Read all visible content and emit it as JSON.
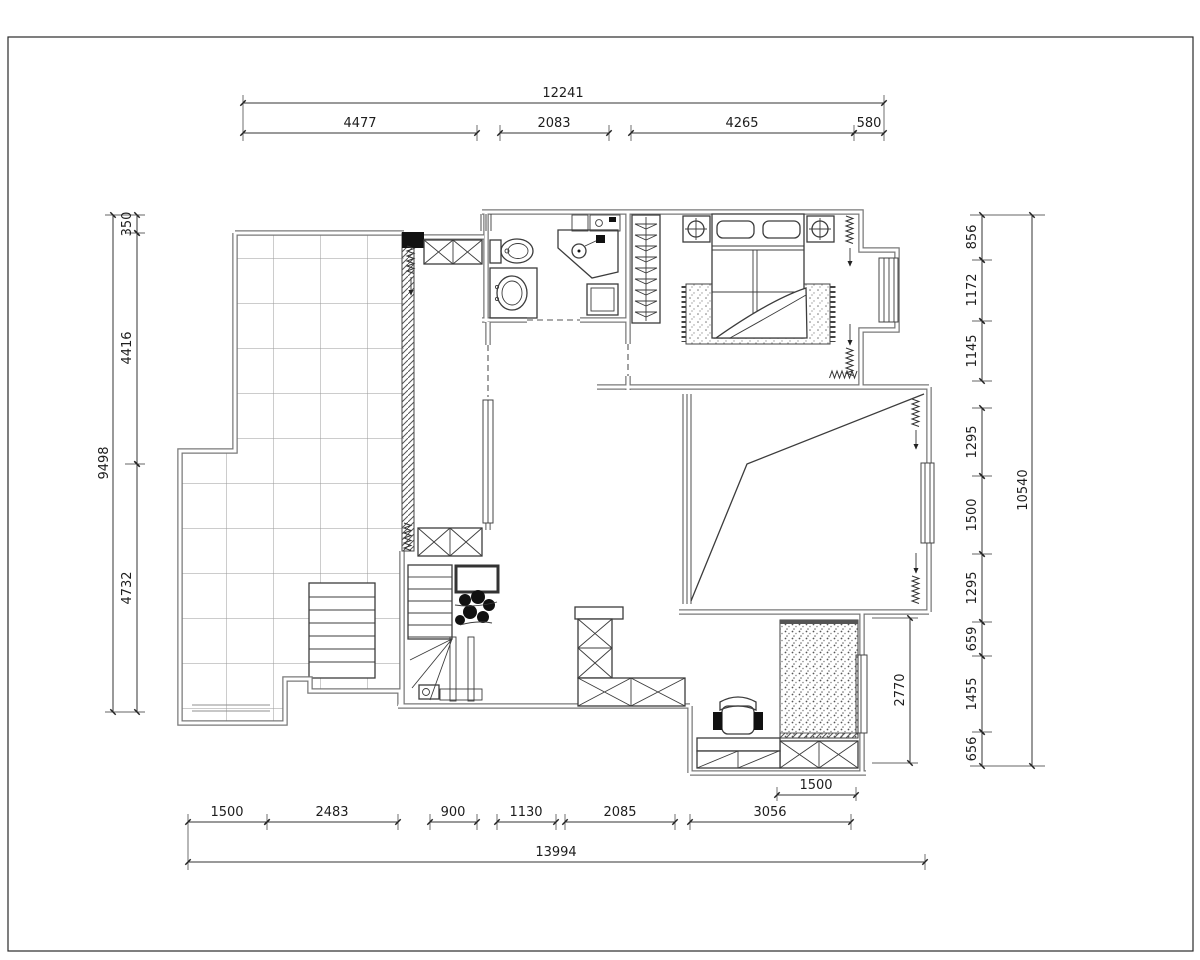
{
  "sheet": {
    "background": "#ffffff",
    "line_color": "#3c3c3c",
    "wall_color": "#787878"
  },
  "dimensions": {
    "top": {
      "overall": "12241",
      "segments": [
        "4477",
        "2083",
        "4265",
        "580"
      ]
    },
    "left": {
      "overall": "9498",
      "segments": [
        "350",
        "4416",
        "4732"
      ]
    },
    "right": {
      "overall": "10540",
      "segments": [
        "856",
        "1172",
        "1145",
        "1295",
        "1500",
        "1295",
        "659",
        "1455",
        "656"
      ],
      "inner_room_height": "2770"
    },
    "bottom": {
      "overall": "13994",
      "segments": [
        "1500",
        "2483",
        "900",
        "1130",
        "2085",
        "3056"
      ],
      "inner_mat_width": "1500"
    }
  }
}
